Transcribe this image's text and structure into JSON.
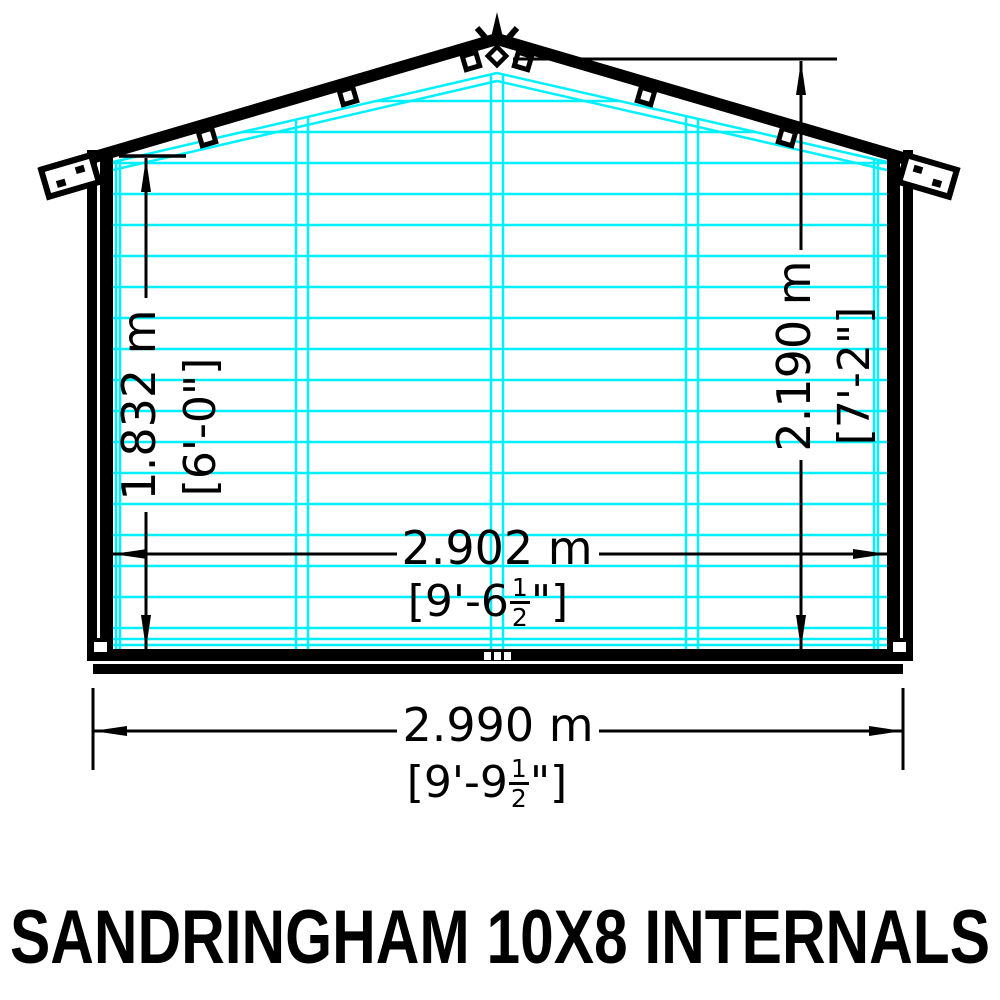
{
  "title": "SANDRINGHAM 10X8 INTERNALS",
  "drawing_type": "shed internal elevation diagram",
  "dims": {
    "left": {
      "name": "internal height to eaves",
      "metric": "1.832 m",
      "imperial": "[6'-0\"]"
    },
    "right": {
      "name": "internal height to ridge",
      "metric": "2.190 m",
      "imperial": "[7'-2\"]"
    },
    "mid": {
      "name": "internal width",
      "metric": "2.902 m",
      "imp_pre": "[9'-6",
      "frac_num": "1",
      "frac_den": "2",
      "imp_post": "\"]"
    },
    "bottom": {
      "name": "external width",
      "metric": "2.990 m",
      "imp_pre": "[9'-9",
      "frac_num": "1",
      "frac_den": "2",
      "imp_post": "\"]"
    }
  },
  "colors": {
    "cladding": "#00f0ff",
    "line": "#000000",
    "background": "#ffffff"
  }
}
